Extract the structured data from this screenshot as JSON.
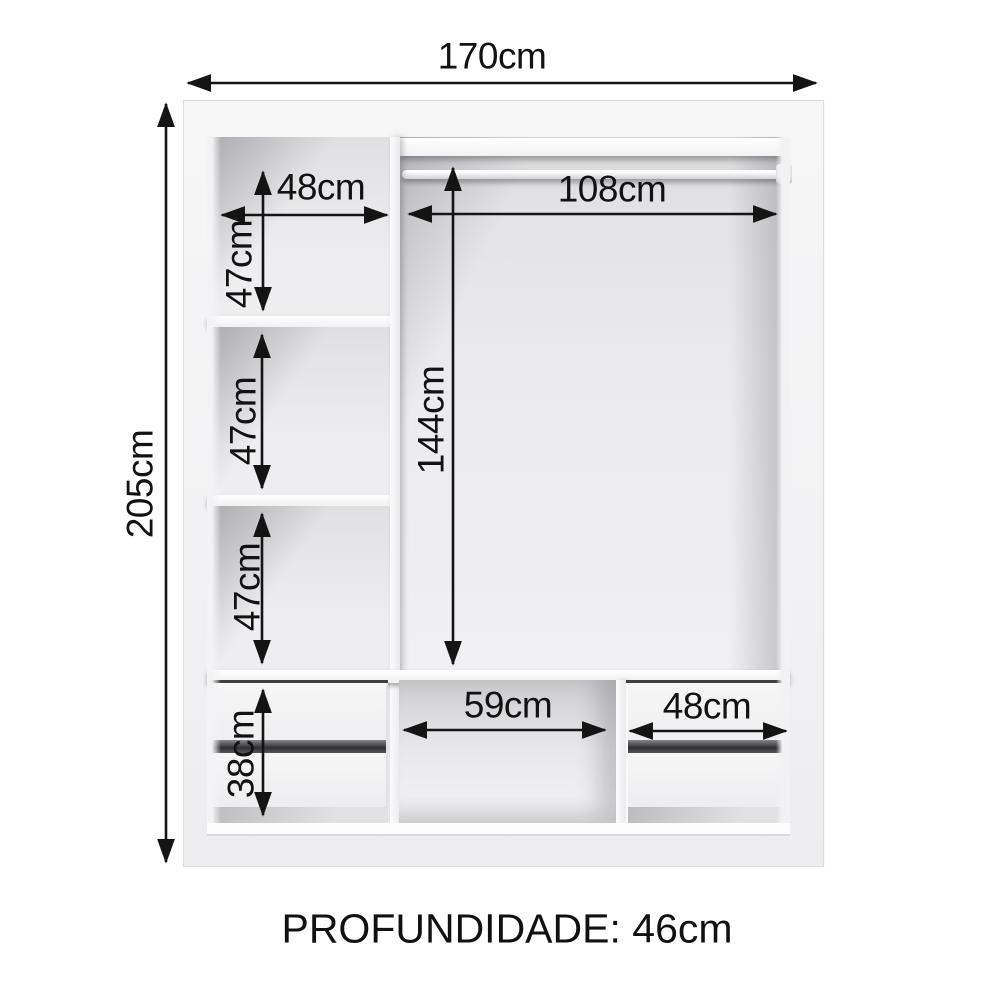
{
  "labels": {
    "total_width": "170cm",
    "total_height": "205cm",
    "top_left_shelf_width": "48cm",
    "left_compartment_1_height": "47cm",
    "left_compartment_2_height": "47cm",
    "left_compartment_3_height": "47cm",
    "hanging_section_width": "108cm",
    "hanging_section_height": "144cm",
    "drawer_stack_height": "38cm",
    "center_niche_width": "59cm",
    "right_drawers_width": "48cm"
  },
  "footer": {
    "depth": "PROFUNDIDADE: 46cm"
  },
  "colors": {
    "dimension_lines": "#141414",
    "panel": "#f3f3f4",
    "interior": "#e9e9eb",
    "background": "#ffffff"
  }
}
